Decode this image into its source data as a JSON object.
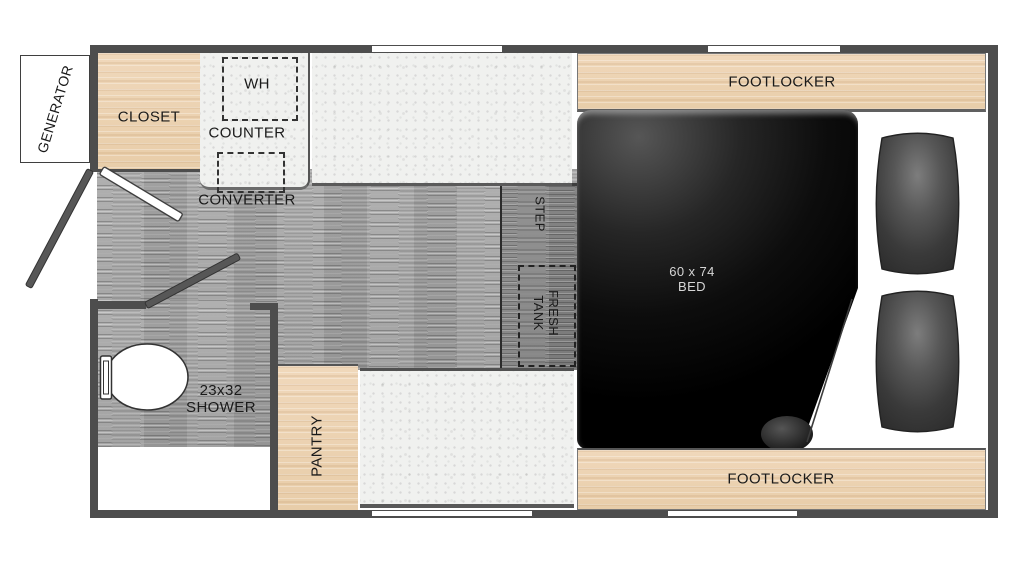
{
  "title": "Truck camper floor plan",
  "labels": {
    "generator": "GENERATOR",
    "closet": "CLOSET",
    "water_heater": "WH",
    "counter": "COUNTER",
    "converter": "CONVERTER",
    "step": "STEP",
    "fresh_tank_line1": "FRESH",
    "fresh_tank_line2": "TANK",
    "bed_line1": "60 x 74",
    "bed_line2": "BED",
    "footlocker_top": "FOOTLOCKER",
    "footlocker_bottom": "FOOTLOCKER",
    "shower_line1": "23x32",
    "shower_line2": "SHOWER",
    "pantry": "PANTRY"
  },
  "colors": {
    "wall": "#4d4d4d",
    "wood": "#e8cda9",
    "floor_gray": "#9e9e9e",
    "counter_speckle": "#f0f1ef",
    "bed_black": "#000000",
    "seat_gray": "#3f3f3f",
    "label_text": "#1a1a1a",
    "bed_text": "#d6d6d6"
  }
}
